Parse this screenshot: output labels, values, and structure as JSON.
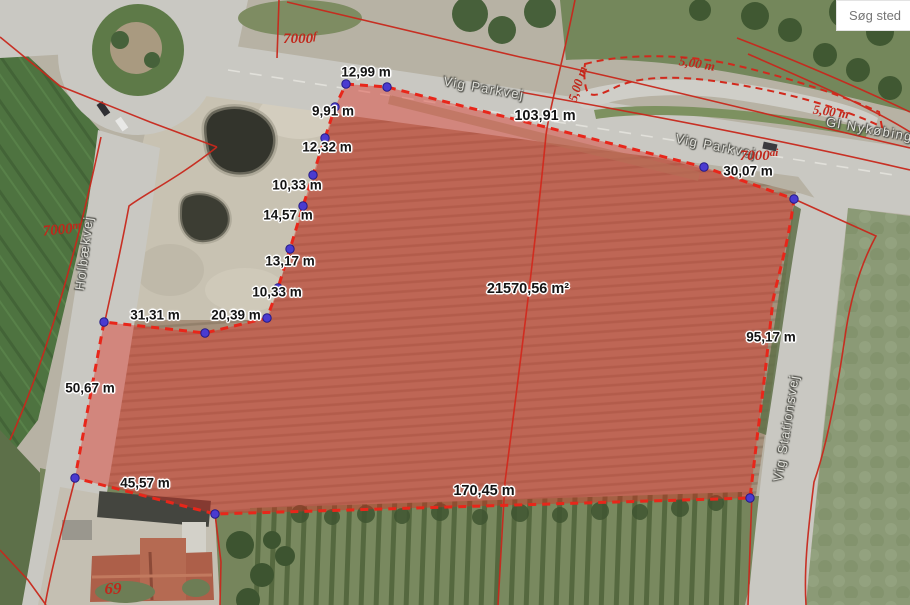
{
  "search": {
    "placeholder": "Søg sted"
  },
  "map": {
    "area_label": {
      "text": "21570,56 m²"
    },
    "measurements": [
      {
        "text": "12,99 m"
      },
      {
        "text": "9,91 m"
      },
      {
        "text": "12,32 m"
      },
      {
        "text": "10,33 m"
      },
      {
        "text": "14,57 m"
      },
      {
        "text": "13,17 m"
      },
      {
        "text": "10,33 m"
      },
      {
        "text": "20,39 m"
      },
      {
        "text": "31,31 m"
      },
      {
        "text": "50,67 m"
      },
      {
        "text": "45,57 m"
      },
      {
        "text": "103,91 m"
      },
      {
        "text": "30,07 m"
      },
      {
        "text": "95,17 m"
      },
      {
        "text": "170,45 m"
      }
    ],
    "parcel_numbers": [
      {
        "base": "7000",
        "suffix": "f"
      },
      {
        "base": "7000",
        "suffix": "m"
      },
      {
        "base": "7000",
        "suffix": "ai"
      }
    ],
    "width_annotations": [
      {
        "text": "5,00 m"
      },
      {
        "text": "5,00 m"
      },
      {
        "text": "5,00 m"
      }
    ],
    "house_number": {
      "text": "69"
    },
    "road_labels": [
      {
        "text": "Vig Parkvej"
      },
      {
        "text": "Vig Parkvej"
      },
      {
        "text": "Gl Nykøbingvej"
      },
      {
        "text": "Holbækvej"
      },
      {
        "text": "Vig Stationsvej"
      }
    ],
    "colors": {
      "measure_outline": "#e8261a",
      "area_fill": "rgba(223,43,30,0.42)",
      "cadastral_line": "#c8281c",
      "vertex_dot": "#4a3bd0",
      "parcel_label": "#c1271b"
    }
  }
}
